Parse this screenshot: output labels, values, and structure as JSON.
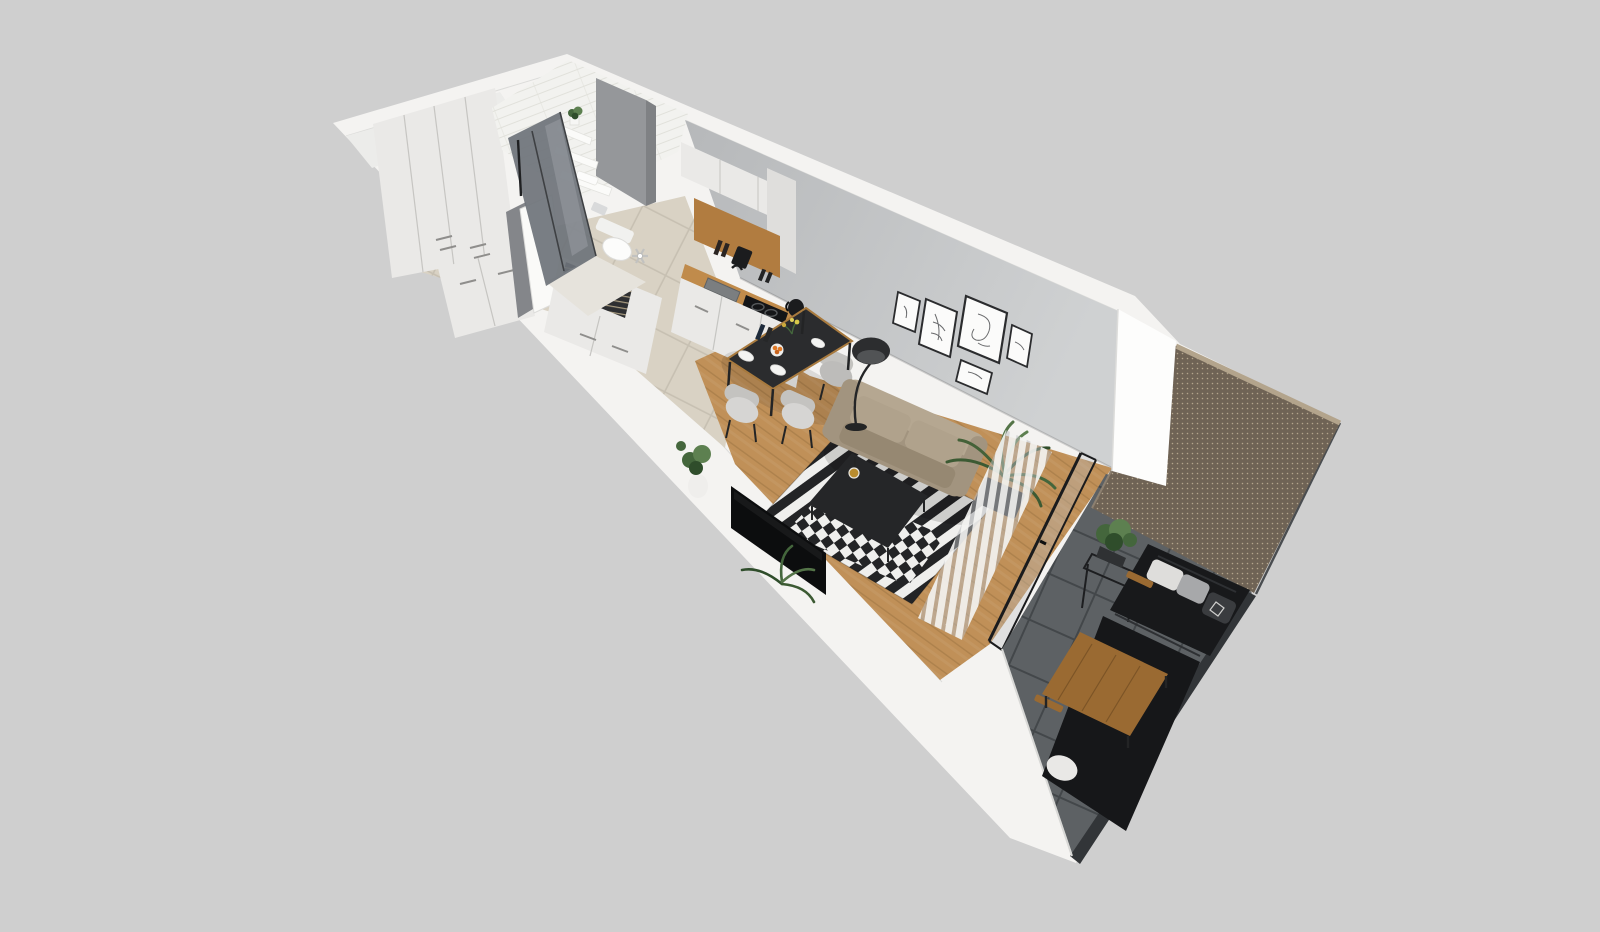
{
  "meta": {
    "type": "3d-apartment-floorplan-render",
    "view": "isometric-dollhouse-top-view",
    "width_px": 1600,
    "height_px": 900
  },
  "colors": {
    "bg": "#cfcfcf",
    "shell": "#f4f3f1",
    "shell_bright": "#fafaf8",
    "shell_edge": "#dcdcda",
    "wall_inner": "#ececea",
    "wall_gray_1": "#b6b8ba",
    "wall_gray_2": "#cfd1d2",
    "bath_tile": "#f2f2ef",
    "bath_tile_line": "#e1e1db",
    "glass_dark": "#6e7379",
    "glass_streak": "#9ba0a5",
    "slab_gray": "#95979a",
    "cabinet": "#eae9e7",
    "cabinet_shade": "#dfdedc",
    "cabinet_line": "#c6c5c2",
    "handle": "#8f8e8c",
    "tile_floor": "#d9d2c4",
    "tile_grout": "#c7c0b2",
    "bath_floor": "#e6e3dc",
    "wood_floor": "#c09058",
    "wood_line": "#a07644",
    "wood_accent": "#b17c40",
    "counter": "#c08b4b",
    "sink": "#7b7e80",
    "appliance": "#1b1c1e",
    "table_top": "#2b2c2e",
    "table_edge": "#a87a3e",
    "plate": "#f4f4f2",
    "orange": "#e07a28",
    "chair": "#d6d5d3",
    "chair_shade": "#c4c3c0",
    "leg": "#232425",
    "lamp": "#2c2d2f",
    "sofa": "#a2947f",
    "sofa_back": "#b5a791",
    "sofa_cushion": "#b0a28c",
    "sofa_seat": "#968872",
    "rug_white": "#efefed",
    "rug_black": "#232426",
    "ctable": "#252628",
    "gold": "#b98c2e",
    "tv": "#0c0d0e",
    "plant_dark": "#2f4d2b",
    "plant_mid": "#44663c",
    "plant_light": "#5d8050",
    "pot_white": "#efeeec",
    "pot_dark": "#2f3133",
    "curtain": "#f3f3f1",
    "curtain_gap": "#b9bcbe",
    "frame": "#2b2c2e",
    "art": "#6a6b6d",
    "pillar": "#fdfdfc",
    "mesh": "#6f6355",
    "mesh_dot": "#c9bb9f",
    "mesh_frame": "#b3a48c",
    "balc_tile": "#5d6164",
    "balc_grout": "#43474a",
    "railing": "#323538",
    "parapet_edge": "#d8d8d6",
    "out_sofa": "#18191b",
    "out_sofa_hi": "#2e3033",
    "out_wood": "#9a6a32",
    "out_wood_line": "#7c5426",
    "pillow_white": "#dedddb",
    "pillow_gray": "#a7a8aa",
    "pillow_dark": "#3a3c3f",
    "toilet": "#fcfcfb",
    "door_gap": "#84868a"
  },
  "scene": {
    "rooms": [
      {
        "name": "hallway",
        "objects": [
          "tall-wardrobe",
          "shoe-cabinet",
          "entry-door",
          "open-clothes-rack",
          "laundry-dresser",
          "fan-decor"
        ]
      },
      {
        "name": "bathroom",
        "objects": [
          "walk-in-shower",
          "wall-hung-toilet",
          "wall-shelves",
          "shelf-plant",
          "towels",
          "tiled-walls"
        ]
      },
      {
        "name": "kitchen",
        "objects": [
          "upper-cabinets",
          "wood-open-shelf",
          "countertop",
          "sink",
          "cooktop",
          "kettle",
          "base-cabinets",
          "coffee-machine"
        ]
      },
      {
        "name": "dining-area",
        "objects": [
          "black-dining-table",
          "upholstered-chairs",
          "plates",
          "fruit-bowl",
          "bottles",
          "flowers",
          "floor-lamp"
        ]
      },
      {
        "name": "living-room",
        "objects": [
          "beige-sofa",
          "black-coffee-table",
          "striped-rug",
          "wall-mounted-tv",
          "gallery-wall-five-frames",
          "potted-palm",
          "white-vase-plant",
          "sheer-slat-curtains",
          "sliding-glass-door"
        ]
      },
      {
        "name": "balcony",
        "objects": [
          "privacy-mesh-screen",
          "white-pillar",
          "dark-outdoor-sofa",
          "decor-pillows",
          "wooden-coffee-table",
          "plant-stand",
          "concrete-tile-floor",
          "glass-railing"
        ]
      }
    ]
  }
}
